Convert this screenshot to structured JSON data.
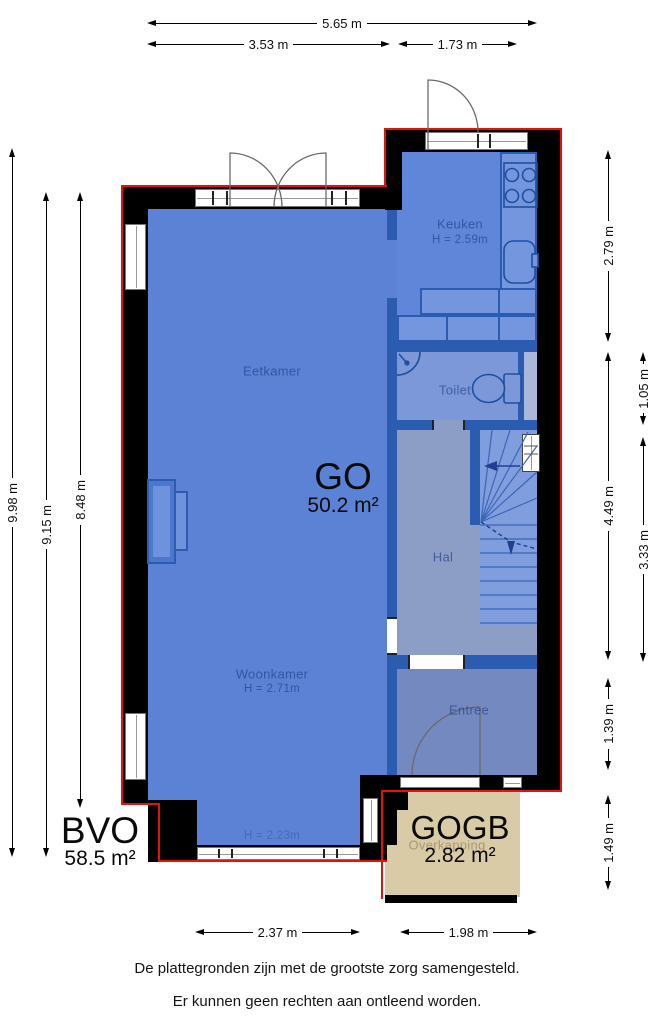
{
  "rooms": {
    "eetkamer": {
      "label": "Eetkamer"
    },
    "keuken": {
      "label": "Keuken",
      "height": "H = 2.59m"
    },
    "toilet": {
      "label": "Toilet"
    },
    "hal": {
      "label": "Hal"
    },
    "woonkamer": {
      "label": "Woonkamer",
      "height": "H = 2.71m"
    },
    "entree": {
      "label": "Entree"
    },
    "overkapping": {
      "label": "Overkapping"
    }
  },
  "areas": {
    "go": {
      "code": "GO",
      "value": "50.2 m²"
    },
    "bvo": {
      "code": "BVO",
      "value": "58.5 m²"
    },
    "gogb": {
      "code": "GOGB",
      "value": "2.82 m²"
    }
  },
  "notes": {
    "rear_window_height": "H = 2.23m"
  },
  "dimensions": {
    "top": [
      "5.65 m",
      "3.53 m",
      "1.73 m"
    ],
    "left": [
      "9.98 m",
      "9.15 m",
      "8.48 m"
    ],
    "right": [
      "2.79 m",
      "4.49 m",
      "1.39 m",
      "1.49 m",
      "1.05 m",
      "3.33 m"
    ],
    "bottom": [
      "2.37 m",
      "1.98 m"
    ]
  },
  "footer": {
    "line1": "De plattegronden zijn met de grootste zorg samengesteld.",
    "line2": "Er kunnen geen rechten aan ontleend worden."
  },
  "colors": {
    "outline_red": "#e8100c",
    "exterior_wall": "#000000",
    "interior_wall": "#2b5cb0",
    "floor_main": "#5b82d4",
    "floor_hall": "#8c9dc6",
    "floor_entree": "#7389c0",
    "overkapping_beige": "#d9cba5"
  }
}
